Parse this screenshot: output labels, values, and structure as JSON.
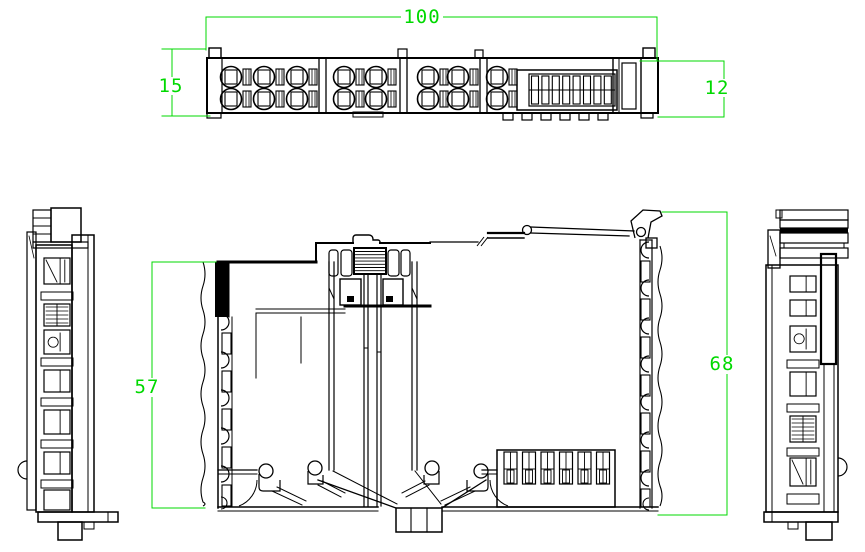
{
  "meta": {
    "drawing_type": "cad-technical-drawing",
    "subject": "din-rail-terminal-io-module-multiview",
    "views": [
      "top-view",
      "left-side-view",
      "front-view",
      "right-side-view"
    ]
  },
  "colors": {
    "dimension": "#00d900",
    "line": "#000000",
    "background": "#ffffff"
  },
  "dimensions": {
    "overall_width": "100",
    "top_left_height": "15",
    "top_right_height": "12",
    "front_left_height": "57",
    "front_right_height": "68"
  },
  "top_view": {
    "terminal_groups": [
      3,
      2,
      2,
      1
    ],
    "terminal_rows": 2,
    "bus_slots": 8,
    "teeth": 6
  },
  "front_view": {
    "connector_slots": 6
  }
}
